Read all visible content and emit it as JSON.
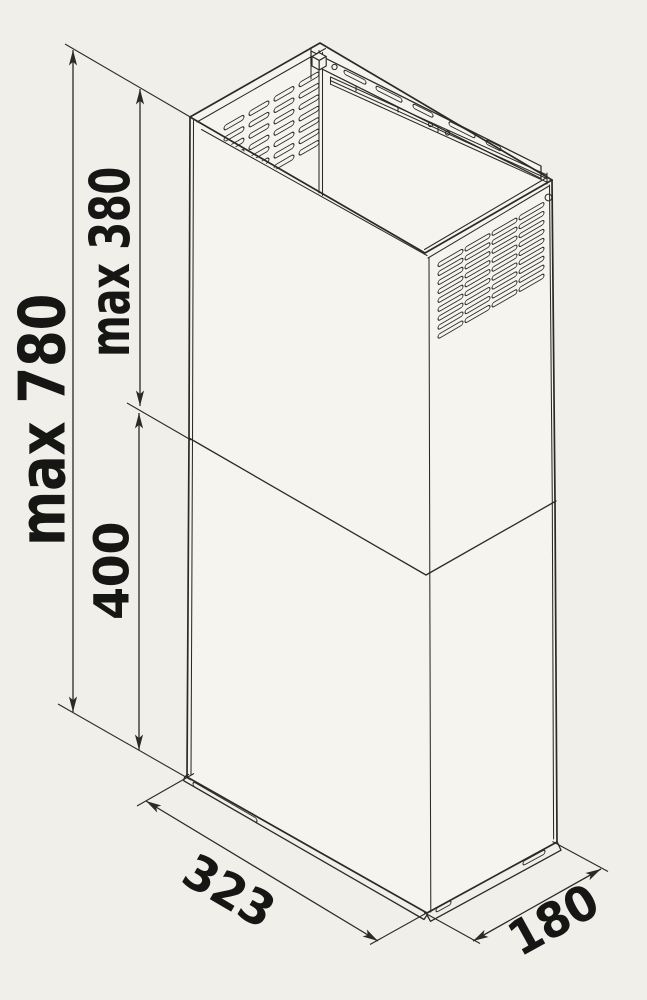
{
  "page": {
    "background": "#f1efe9"
  },
  "drawing": {
    "subject": "Telescopic chimney flue cover - isometric dimension drawing",
    "units": "mm",
    "colors": {
      "background": "#f1efe9",
      "face": "#f6f4ef",
      "line": "#2b2a26",
      "text": "#161615"
    }
  },
  "dimensions": {
    "total_height": {
      "label": "max 780",
      "meaning": "maximum total height"
    },
    "upper_section_height": {
      "label": "max 380",
      "meaning": "maximum upper telescopic section height"
    },
    "lower_section_height": {
      "label": "400",
      "meaning": "lower section height"
    },
    "base_width": {
      "label": "323",
      "meaning": "base width"
    },
    "base_depth": {
      "label": "180",
      "meaning": "base depth"
    }
  }
}
